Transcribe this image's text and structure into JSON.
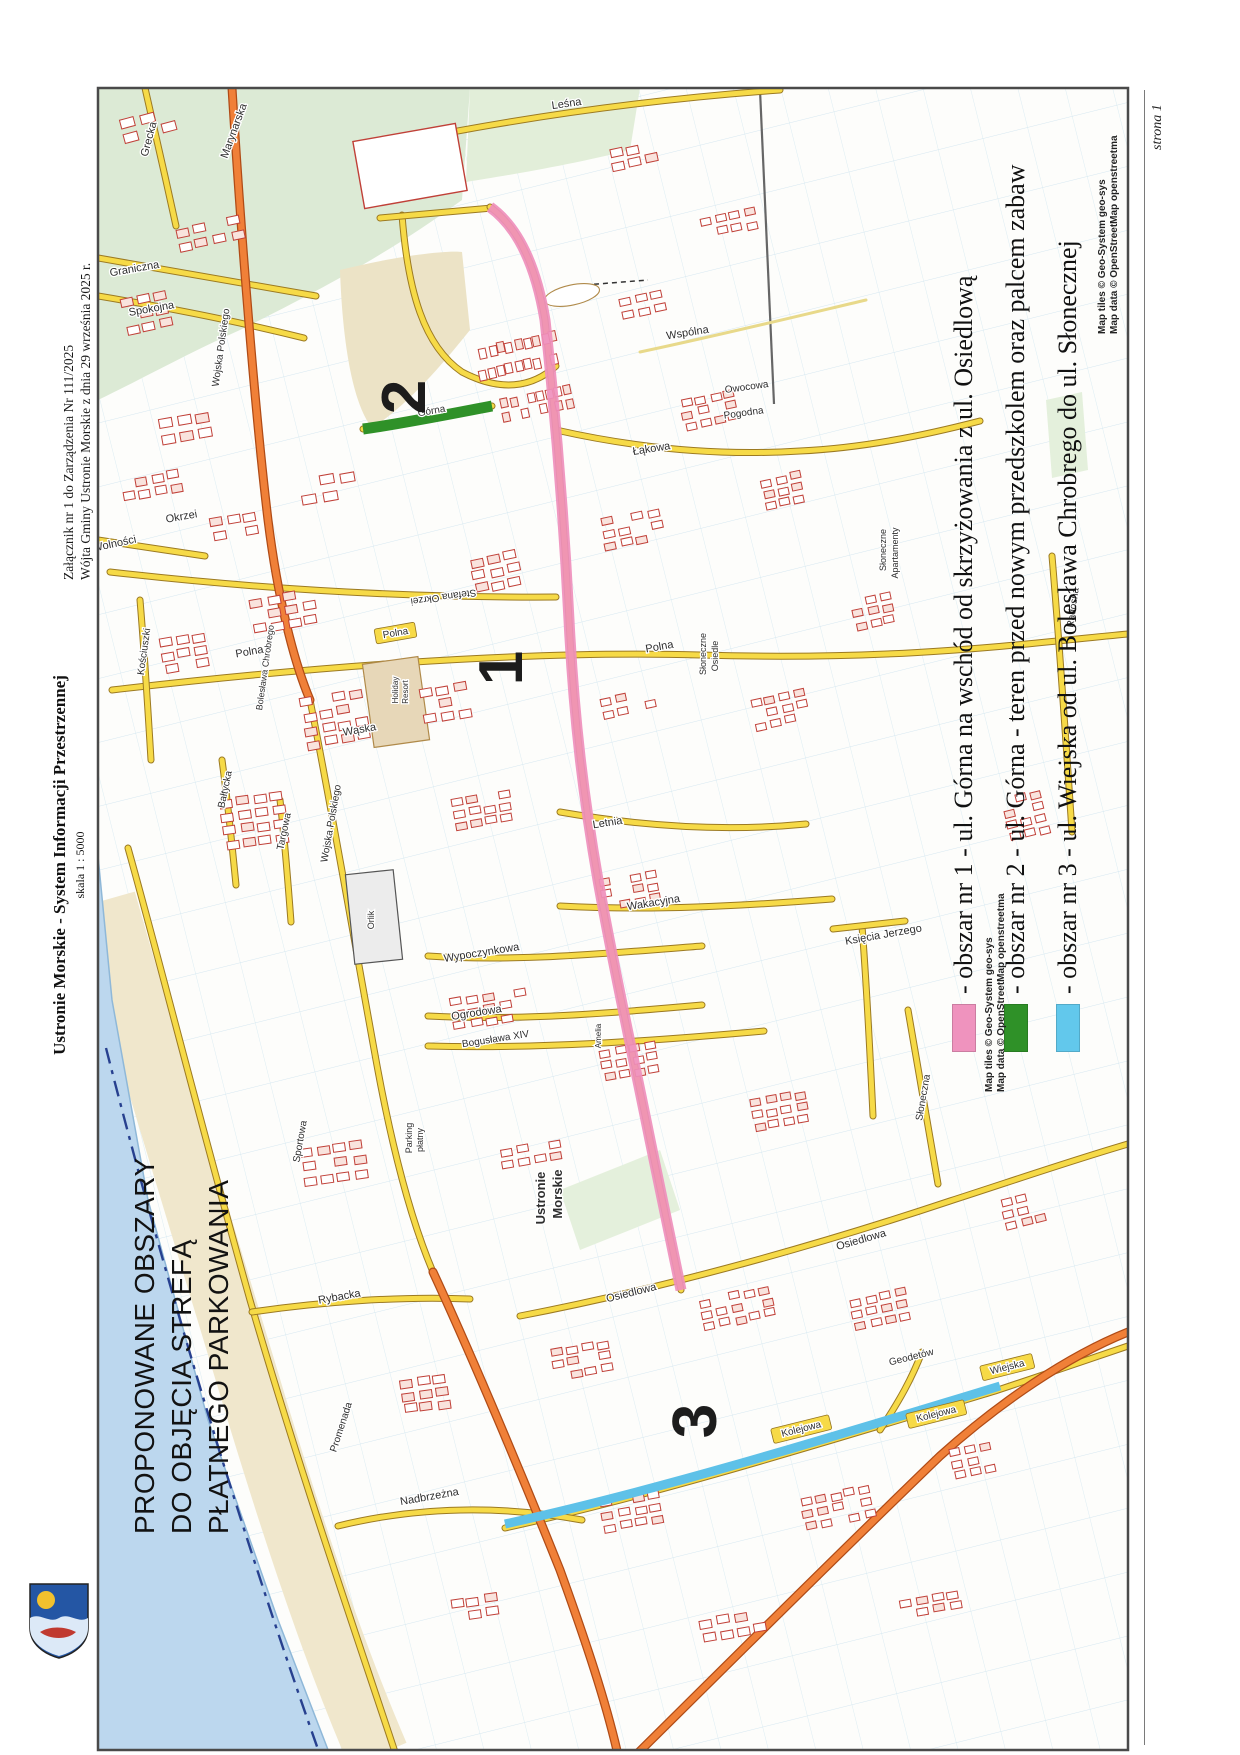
{
  "page": {
    "header_line1": "Załącznik nr 1 do Zarządzenia Nr 111/2025",
    "header_line2": "Wójta Gminy Ustronie Morskie z dnia 29 września 2025 r.",
    "subtitle_bold": "Ustronie Morskie - System Informacji Przestrzennej",
    "scale": "skala 1 : 5000",
    "title_lines": [
      "PROPONOWANE OBSZARY",
      "DO OBJĘCIA STREFĄ",
      "PŁATNEGO PARKOWANIA"
    ],
    "page_number": "strona 1"
  },
  "legend": {
    "entries": [
      {
        "color": "#ef93be",
        "label": "- obszar nr 1 - ul. Górna na wschód od skrzyżowania z ul. Osiedlową"
      },
      {
        "color": "#2f9128",
        "label": "- obszar nr 2 - ul. Górna - teren przed nowym przedszkolem oraz palcem zabaw"
      },
      {
        "color": "#62c8ec",
        "label": "- obszar nr 3 - ul. Wiejska od ul. Bolesława Chrobrego do ul. Słonecznej"
      }
    ]
  },
  "attribution": {
    "tiles": "Map tiles © Geo-System geo-sys",
    "data": "Map data © OpenStreetMap openstreetma"
  },
  "colors": {
    "area1_pink": "#ef8fbc",
    "area2_green": "#2f9128",
    "area3_blue": "#5ec1e8",
    "road_yellow": "#f6da47",
    "road_orange": "#f08038",
    "sea": "#bcd7ee",
    "beach": "#f0e7cc",
    "forest": "#dcead5",
    "parcel_line": "#9ec9e2",
    "building_outline": "#c04038"
  },
  "map": {
    "area_numbers": [
      {
        "n": "1",
        "x": 522,
        "y": 668
      },
      {
        "n": "2",
        "x": 425,
        "y": 397
      },
      {
        "n": "3",
        "x": 716,
        "y": 1421
      }
    ],
    "labels": [
      {
        "t": "Grecka",
        "x": 152,
        "y": 140,
        "r": -75,
        "s": 11
      },
      {
        "t": "Marynarska",
        "x": 237,
        "y": 132,
        "r": -70,
        "s": 11
      },
      {
        "t": "Graniczna",
        "x": 135,
        "y": 272,
        "r": -10,
        "s": 11
      },
      {
        "t": "Spokojna",
        "x": 152,
        "y": 312,
        "r": -10,
        "s": 11
      },
      {
        "t": "Wojska Polskiego",
        "x": 224,
        "y": 348,
        "r": -82,
        "s": 10
      },
      {
        "t": "Leśna",
        "x": 567,
        "y": 107,
        "r": -8,
        "s": 11
      },
      {
        "t": "Wspólna",
        "x": 688,
        "y": 336,
        "r": -9,
        "s": 11
      },
      {
        "t": "Owocowa",
        "x": 747,
        "y": 390,
        "r": -8,
        "s": 10
      },
      {
        "t": "Pogodna",
        "x": 744,
        "y": 416,
        "r": -8,
        "s": 10
      },
      {
        "t": "Łąkowa",
        "x": 652,
        "y": 452,
        "r": -9,
        "s": 11
      },
      {
        "t": "Słoneczne",
        "x": 886,
        "y": 550,
        "r": -90,
        "s": 9
      },
      {
        "t": "Apartamenty",
        "x": 898,
        "y": 553,
        "r": -90,
        "s": 9
      },
      {
        "t": "Okrzei",
        "x": 182,
        "y": 520,
        "r": -10,
        "s": 11
      },
      {
        "t": "Stefana Okrzei",
        "x": 443,
        "y": 594,
        "r": 172,
        "s": 10
      },
      {
        "t": "Wolności",
        "x": 115,
        "y": 547,
        "r": -12,
        "s": 11
      },
      {
        "t": "Polna",
        "x": 660,
        "y": 650,
        "r": -10,
        "s": 11
      },
      {
        "t": "Polna",
        "x": 396,
        "y": 636,
        "r": -10,
        "s": 10,
        "b": 1
      },
      {
        "t": "Polna",
        "x": 250,
        "y": 655,
        "r": -10,
        "s": 11
      },
      {
        "t": "Kościuszki",
        "x": 147,
        "y": 652,
        "r": -82,
        "s": 10
      },
      {
        "t": "Bolesława Chrobrego",
        "x": 268,
        "y": 668,
        "r": -82,
        "s": 9
      },
      {
        "t": "Wąska",
        "x": 360,
        "y": 733,
        "r": -10,
        "s": 11
      },
      {
        "t": "Holiday",
        "x": 398,
        "y": 690,
        "r": -90,
        "s": 8
      },
      {
        "t": "Resort",
        "x": 408,
        "y": 692,
        "r": -90,
        "s": 8
      },
      {
        "t": "Bałtycka",
        "x": 228,
        "y": 790,
        "r": -78,
        "s": 10
      },
      {
        "t": "Targowa",
        "x": 287,
        "y": 832,
        "r": -78,
        "s": 10
      },
      {
        "t": "Wojska Polskiego",
        "x": 334,
        "y": 824,
        "r": -80,
        "s": 10
      },
      {
        "t": "Letnia",
        "x": 608,
        "y": 826,
        "r": -9,
        "s": 11
      },
      {
        "t": "Księcia Jerzego",
        "x": 884,
        "y": 938,
        "r": -10,
        "s": 11
      },
      {
        "t": "Wakacyjna",
        "x": 654,
        "y": 906,
        "r": -9,
        "s": 11
      },
      {
        "t": "Wypoczynkowa",
        "x": 482,
        "y": 956,
        "r": -9,
        "s": 11
      },
      {
        "t": "Orlik",
        "x": 374,
        "y": 920,
        "r": -90,
        "s": 9
      },
      {
        "t": "Ogrodowa",
        "x": 477,
        "y": 1016,
        "r": -9,
        "s": 11
      },
      {
        "t": "Bogusława XIV",
        "x": 496,
        "y": 1042,
        "r": -9,
        "s": 10
      },
      {
        "t": "Ustronie",
        "x": 545,
        "y": 1198,
        "r": -90,
        "s": 13,
        "f": 1
      },
      {
        "t": "Morskie",
        "x": 562,
        "y": 1194,
        "r": -90,
        "s": 13,
        "f": 1
      },
      {
        "t": "Amelia",
        "x": 601,
        "y": 1036,
        "r": -90,
        "s": 8
      },
      {
        "t": "Parking",
        "x": 412,
        "y": 1138,
        "r": -90,
        "s": 9
      },
      {
        "t": "płatny",
        "x": 423,
        "y": 1140,
        "r": -90,
        "s": 9
      },
      {
        "t": "Osiedlowa",
        "x": 632,
        "y": 1296,
        "r": -14,
        "s": 11
      },
      {
        "t": "Osiedlowa",
        "x": 862,
        "y": 1243,
        "r": -16,
        "s": 11
      },
      {
        "t": "Słoneczna",
        "x": 926,
        "y": 1098,
        "r": -80,
        "s": 10
      },
      {
        "t": "Radosna",
        "x": 1076,
        "y": 608,
        "r": -82,
        "s": 10
      },
      {
        "t": "Rybacka",
        "x": 340,
        "y": 1300,
        "r": -10,
        "s": 11
      },
      {
        "t": "Wiejska",
        "x": 1008,
        "y": 1370,
        "r": -14,
        "s": 10,
        "b": 1
      },
      {
        "t": "Geodetów",
        "x": 912,
        "y": 1360,
        "r": -14,
        "s": 10
      },
      {
        "t": "Kolejowa",
        "x": 802,
        "y": 1432,
        "r": -14,
        "s": 10,
        "b": 1
      },
      {
        "t": "Kolejowa",
        "x": 937,
        "y": 1417,
        "r": -14,
        "s": 10,
        "b": 1
      },
      {
        "t": "Nadbrzeżna",
        "x": 430,
        "y": 1500,
        "r": -10,
        "s": 11
      },
      {
        "t": "Promenada",
        "x": 344,
        "y": 1428,
        "r": -72,
        "s": 10
      },
      {
        "t": "Sportowa",
        "x": 303,
        "y": 1142,
        "r": -80,
        "s": 10
      },
      {
        "t": "Górna",
        "x": 432,
        "y": 414,
        "r": -10,
        "s": 10
      },
      {
        "t": "Słoneczne",
        "x": 706,
        "y": 654,
        "r": -90,
        "s": 9
      },
      {
        "t": "Osiedle",
        "x": 718,
        "y": 656,
        "r": -90,
        "s": 9
      }
    ],
    "building_clusters": [
      [
        120,
        120,
        3,
        2,
        14,
        9,
        20,
        16,
        -15
      ],
      [
        175,
        230,
        4,
        2,
        12,
        8,
        18,
        14,
        -12
      ],
      [
        120,
        300,
        3,
        3,
        12,
        8,
        17,
        14,
        -12
      ],
      [
        160,
        420,
        3,
        2,
        13,
        9,
        18,
        15,
        -10
      ],
      [
        120,
        480,
        4,
        2,
        11,
        8,
        16,
        13,
        -10
      ],
      [
        210,
        520,
        3,
        2,
        12,
        8,
        17,
        14,
        -10
      ],
      [
        300,
        480,
        3,
        2,
        14,
        9,
        20,
        16,
        -10
      ],
      [
        610,
        150,
        3,
        2,
        12,
        8,
        17,
        13,
        -12
      ],
      [
        700,
        220,
        4,
        2,
        10,
        7,
        15,
        12,
        -12
      ],
      [
        620,
        300,
        3,
        2,
        11,
        7,
        16,
        12,
        -12
      ],
      [
        680,
        400,
        4,
        3,
        10,
        7,
        15,
        12,
        -12
      ],
      [
        760,
        480,
        3,
        3,
        10,
        7,
        15,
        12,
        -12
      ],
      [
        600,
        520,
        4,
        3,
        11,
        7,
        16,
        12,
        -12
      ],
      [
        470,
        560,
        3,
        3,
        12,
        8,
        17,
        13,
        -12
      ],
      [
        250,
        600,
        4,
        3,
        12,
        8,
        17,
        13,
        -10
      ],
      [
        160,
        640,
        3,
        3,
        12,
        8,
        16,
        13,
        -10
      ],
      [
        300,
        700,
        4,
        4,
        12,
        8,
        17,
        14,
        -10
      ],
      [
        220,
        800,
        4,
        4,
        12,
        8,
        17,
        14,
        -8
      ],
      [
        420,
        690,
        3,
        3,
        12,
        8,
        17,
        13,
        -10
      ],
      [
        600,
        700,
        4,
        2,
        10,
        7,
        15,
        12,
        -12
      ],
      [
        750,
        700,
        4,
        3,
        10,
        7,
        15,
        12,
        -12
      ],
      [
        450,
        800,
        4,
        3,
        11,
        7,
        16,
        12,
        -10
      ],
      [
        600,
        880,
        4,
        3,
        10,
        7,
        15,
        12,
        -10
      ],
      [
        450,
        1000,
        5,
        3,
        11,
        7,
        16,
        12,
        -10
      ],
      [
        600,
        1050,
        4,
        3,
        10,
        7,
        15,
        12,
        -10
      ],
      [
        750,
        1100,
        4,
        3,
        10,
        7,
        15,
        12,
        -10
      ],
      [
        300,
        1150,
        4,
        3,
        12,
        8,
        17,
        14,
        -8
      ],
      [
        500,
        1150,
        4,
        2,
        11,
        7,
        16,
        12,
        -10
      ],
      [
        700,
        1300,
        5,
        3,
        10,
        7,
        15,
        12,
        -12
      ],
      [
        850,
        1300,
        4,
        3,
        10,
        7,
        15,
        12,
        -12
      ],
      [
        550,
        1350,
        4,
        3,
        11,
        7,
        16,
        12,
        -10
      ],
      [
        400,
        1380,
        3,
        3,
        12,
        8,
        17,
        13,
        -8
      ],
      [
        600,
        1500,
        4,
        3,
        11,
        7,
        16,
        13,
        -10
      ],
      [
        800,
        1500,
        5,
        3,
        10,
        7,
        15,
        12,
        -12
      ],
      [
        950,
        1450,
        3,
        3,
        10,
        7,
        15,
        12,
        -12
      ],
      [
        700,
        1620,
        4,
        2,
        12,
        8,
        17,
        14,
        -10
      ],
      [
        450,
        1600,
        3,
        2,
        12,
        8,
        17,
        13,
        -8
      ],
      [
        900,
        1600,
        4,
        2,
        11,
        7,
        16,
        12,
        -10
      ],
      [
        1000,
        1200,
        3,
        3,
        10,
        7,
        15,
        12,
        -14
      ],
      [
        1000,
        800,
        3,
        4,
        10,
        7,
        15,
        12,
        -14
      ],
      [
        850,
        600,
        3,
        3,
        10,
        7,
        15,
        12,
        -12
      ],
      [
        470,
        350,
        10,
        1,
        7,
        10,
        9,
        14,
        -12
      ],
      [
        470,
        372,
        10,
        1,
        7,
        10,
        9,
        14,
        -12
      ],
      [
        500,
        400,
        8,
        2,
        7,
        9,
        9,
        14,
        -12
      ]
    ]
  }
}
